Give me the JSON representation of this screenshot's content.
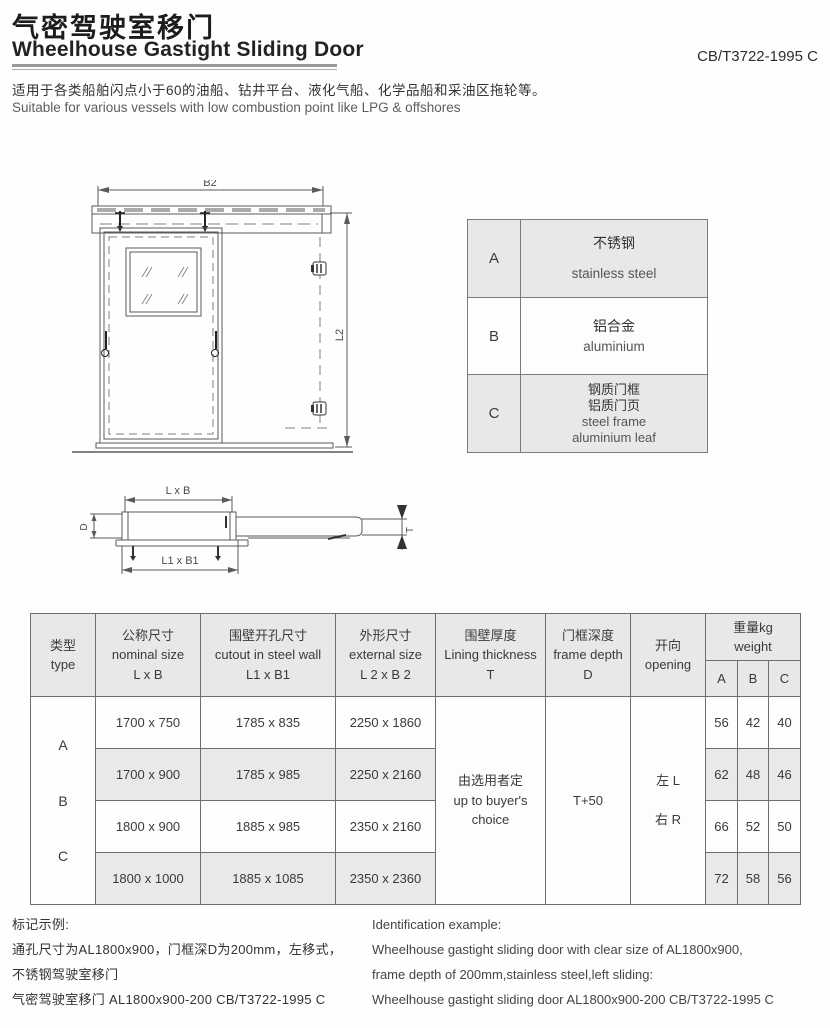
{
  "header": {
    "title_zh": "气密驾驶室移门",
    "title_en": "Wheelhouse Gastight Sliding Door",
    "standard_code": "CB/T3722-1995 C",
    "desc_zh": "适用于各类船舶闪点小于60的油船、钻井平台、液化气船、化学品船和采油区拖轮等。",
    "desc_en": "Suitable for various vessels with low combustion point like LPG & offshores"
  },
  "drawing": {
    "front_view": {
      "dim_width": "B2",
      "dim_height": "L2"
    },
    "top_view": {
      "dim_nominal": "L x B",
      "dim_depth": "D",
      "dim_cutout": "L1 x B1",
      "dim_thickness": "T"
    }
  },
  "materials_table": {
    "rows": [
      {
        "key": "A",
        "zh": "不锈钢",
        "en": "stainless steel"
      },
      {
        "key": "B",
        "zh": "铝合金",
        "en": "aluminium"
      },
      {
        "key": "C",
        "zh": "钢质门框\n铝质门页",
        "en": "steel frame\naluminium leaf"
      }
    ]
  },
  "main_table": {
    "headers": {
      "type": "类型\ntype",
      "nominal": "公称尺寸\nnominal size\nL x B",
      "cutout": "围壁开孔尺寸\ncutout in steel wall\nL1 x B1",
      "external": "外形尺寸\nexternal size\nL 2  x B 2",
      "lining": "围壁厚度\nLining thickness\nT",
      "frame_depth": "门框深度\nframe depth\nD",
      "opening": "开向\nopening",
      "weight": "重量kg\nweight",
      "weight_subs": [
        "A",
        "B",
        "C"
      ]
    },
    "type_letters": [
      "A",
      "B",
      "C"
    ],
    "rows": [
      {
        "nominal": "1700 x 750",
        "cutout": "1785 x 835",
        "external": "2250 x 1860",
        "weights": [
          "56",
          "42",
          "40"
        ]
      },
      {
        "nominal": "1700 x 900",
        "cutout": "1785 x 985",
        "external": "2250 x 2160",
        "weights": [
          "62",
          "48",
          "46"
        ]
      },
      {
        "nominal": "1800 x 900",
        "cutout": "1885 x 985",
        "external": "2350 x 2160",
        "weights": [
          "66",
          "52",
          "50"
        ]
      },
      {
        "nominal": "1800 x 1000",
        "cutout": "1885 x 1085",
        "external": "2350 x 2360",
        "weights": [
          "72",
          "58",
          "56"
        ]
      }
    ],
    "merged": {
      "lining": "由选用者定\nup to buyer's\nchoice",
      "frame_depth": "T+50",
      "opening": "左 L\n\n右 R"
    }
  },
  "footer": {
    "left": [
      "标记示例:",
      "通孔尺寸为AL1800x900，门框深D为200mm，左移式，",
      "不锈钢驾驶室移门",
      "气密驾驶室移门 AL1800x900-200 CB/T3722-1995 C"
    ],
    "right": [
      "Identification example:",
      "Wheelhouse gastight sliding door with clear size of AL1800x900,",
      "frame depth of 200mm,stainless steel,left sliding:",
      "Wheelhouse gastight sliding door AL1800x900-200 CB/T3722-1995 C"
    ]
  },
  "colors": {
    "row_gray": "#e8e8e8",
    "border": "#6e6e6e",
    "text": "#333333"
  }
}
